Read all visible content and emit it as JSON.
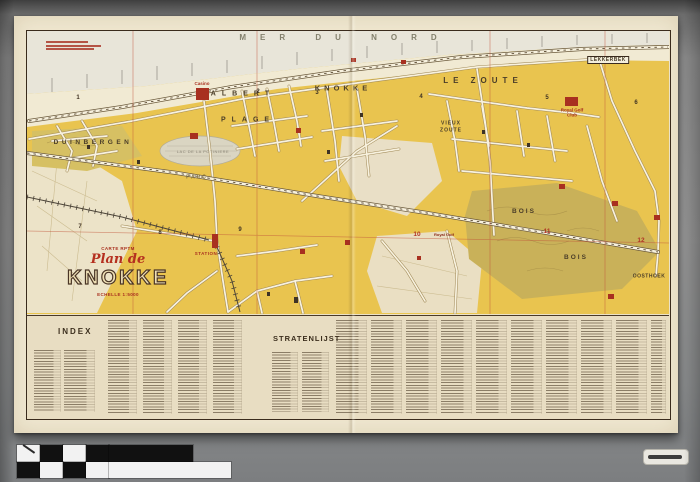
{
  "title_block": {
    "series": "CARTE RPTM",
    "plan": "Plan de",
    "city": "KNOKKE",
    "scale": "ECHELLE 1:5000"
  },
  "sea": {
    "label": "MER DU NORD"
  },
  "regions": {
    "duinbergen": "DUINBERGEN",
    "albert": "ALBERT",
    "plage": "PLAGE",
    "knokke": "KNOKKE",
    "le_zoute": "LE ZOUTE",
    "vieux": "VIEUX",
    "zoute": "ZOUTE",
    "lekkerbek": "LEKKERBEK",
    "bois_1": "BOIS",
    "bois_2": "BOIS",
    "oosthoek": "OOSTHOEK",
    "parc": "PARC"
  },
  "water": {
    "lake": "LAC DE LA POTINIERE"
  },
  "poi": {
    "casino": "Casino",
    "station": "STATION",
    "golf_club": "Royal Golf Club",
    "golf_area": "Royal Golf"
  },
  "sections": {
    "s1": "1",
    "s2": "2",
    "s3": "3",
    "s4": "4",
    "s5": "5",
    "s6": "6",
    "s7": "7",
    "s8": "8",
    "s9": "9",
    "s10": "10",
    "s11": "11",
    "s12": "12"
  },
  "index_panel": {
    "index": "INDEX",
    "stratenlijst": "STRATENLIJST"
  },
  "colors": {
    "map_yellow": "#e9c44f",
    "wood_olive": "#c9b159",
    "landmark_red": "#a83020",
    "grid_red": "#c1543a",
    "paper": "#f0e8d1"
  }
}
